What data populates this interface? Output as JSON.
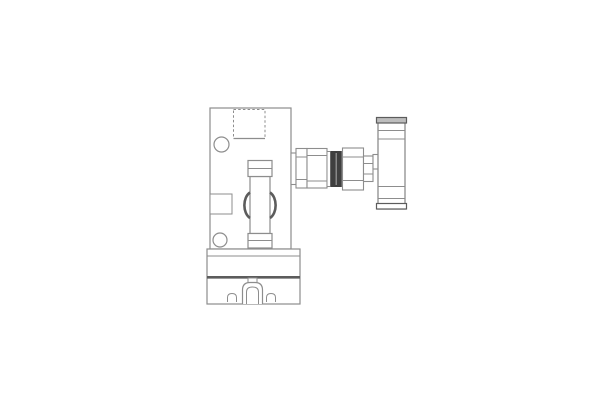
{
  "diagram": {
    "type": "technical-drawing",
    "description": "Orthographic line drawing of a valve fitting assembly with T-handle mounted on a plate and base block",
    "canvas": {
      "width": 600,
      "height": 400,
      "background": "#ffffff"
    },
    "palette": {
      "line": "#8d8d8d",
      "line_dark": "#5c5c5c",
      "seal_dark": "#3f3f3f",
      "cap_fill": "#bdbdbd",
      "white": "#ffffff"
    },
    "parts": [
      {
        "name": "mounting-plate",
        "shape": "rect",
        "x": 210,
        "y": 108,
        "w": 81,
        "h": 141,
        "stroke": "line",
        "fill": "white",
        "sw": 1.2
      },
      {
        "name": "base-block",
        "shape": "rect",
        "x": 207,
        "y": 249,
        "w": 93,
        "h": 55,
        "stroke": "line",
        "fill": "white",
        "sw": 1.2
      },
      {
        "name": "base-upper-line",
        "shape": "line",
        "x1": 207,
        "y1": 256,
        "x2": 300,
        "y2": 256,
        "stroke": "line",
        "sw": 1
      },
      {
        "name": "base-heavy-line",
        "shape": "line",
        "x1": 207,
        "y1": 277.3,
        "x2": 300,
        "y2": 277.3,
        "stroke": "line_dark",
        "sw": 2.6
      },
      {
        "name": "square-cutout",
        "shape": "rect",
        "x": 233.5,
        "y": 109.5,
        "w": 31.5,
        "h": 29,
        "stroke": "line",
        "fill": "none",
        "sw": 1,
        "dash": "2.5,2.2"
      },
      {
        "name": "square-cutout-bottom-edge",
        "shape": "line",
        "x1": 233.5,
        "y1": 138.5,
        "x2": 265,
        "y2": 138.5,
        "stroke": "line",
        "sw": 1.2
      },
      {
        "name": "upper-bolt-hole",
        "shape": "circle",
        "cx": 221.5,
        "cy": 144.5,
        "r": 7.5,
        "stroke": "line",
        "fill": "white",
        "sw": 1.2
      },
      {
        "name": "side-port-block",
        "shape": "rect",
        "x": 210,
        "y": 194,
        "w": 22,
        "h": 20,
        "stroke": "line",
        "fill": "white",
        "sw": 1
      },
      {
        "name": "lower-bolt-hole",
        "shape": "circle",
        "cx": 220,
        "cy": 240,
        "r": 7,
        "stroke": "line",
        "fill": "white",
        "sw": 1.2
      },
      {
        "name": "spindle-body",
        "shape": "rect",
        "x": 250,
        "y": 176.5,
        "w": 20,
        "h": 57,
        "stroke": "line",
        "fill": "white",
        "sw": 1.2
      },
      {
        "name": "spindle-top-collar",
        "shape": "rect",
        "x": 248,
        "y": 160.5,
        "w": 24,
        "h": 16,
        "stroke": "line",
        "fill": "white",
        "sw": 1.2
      },
      {
        "name": "spindle-top-collar-line",
        "shape": "line",
        "x1": 248,
        "y1": 168.5,
        "x2": 272,
        "y2": 168.5,
        "stroke": "line",
        "sw": 1
      },
      {
        "name": "spindle-bottom-collar",
        "shape": "rect",
        "x": 248,
        "y": 233.5,
        "w": 24,
        "h": 14.5,
        "stroke": "line",
        "fill": "white",
        "sw": 1.2
      },
      {
        "name": "spindle-bottom-collar-line",
        "shape": "line",
        "x1": 248,
        "y1": 240.5,
        "x2": 272,
        "y2": 240.5,
        "stroke": "line",
        "sw": 1
      },
      {
        "name": "left-grip-arc",
        "shape": "path",
        "d": "M 250 192.5 C 242.5 197.5 242.5 213 250 218",
        "stroke": "line_dark",
        "fill": "none",
        "sw": 2.6
      },
      {
        "name": "right-grip-arc",
        "shape": "path",
        "d": "M 270 192.5 C 277.5 197.5 277.5 213 270 218",
        "stroke": "line_dark",
        "fill": "none",
        "sw": 2.6
      },
      {
        "name": "clamp-foot-tab",
        "shape": "rect",
        "x": 248,
        "y": 278,
        "w": 9,
        "h": 4.5,
        "stroke": "line",
        "fill": "white",
        "sw": 1
      },
      {
        "name": "clamp-foot-outer",
        "shape": "path",
        "d": "M 242.5 304 L 242.5 290 Q 242.5 282.5 250 282.5 L 255 282.5 Q 262.5 282.5 262.5 290 L 262.5 304",
        "stroke": "line",
        "fill": "white",
        "sw": 1.2
      },
      {
        "name": "clamp-foot-inner",
        "shape": "path",
        "d": "M 246.5 304 L 246.5 292 Q 246.5 287 252.5 287 Q 258.5 287 258.5 292 L 258.5 304",
        "stroke": "line",
        "fill": "none",
        "sw": 1
      },
      {
        "name": "left-foot-hole",
        "shape": "path",
        "d": "M 227.5 302 L 227.5 297.5 Q 227.5 293.5 232 293.5 Q 236.5 293.5 236.5 297.5 L 236.5 302",
        "stroke": "line",
        "fill": "none",
        "sw": 1
      },
      {
        "name": "right-foot-hole",
        "shape": "path",
        "d": "M 266.5 302 L 266.5 297.5 Q 266.5 293.5 271 293.5 Q 275.5 293.5 275.5 297.5 L 275.5 302",
        "stroke": "line",
        "fill": "none",
        "sw": 1
      },
      {
        "name": "union-washer",
        "shape": "rect",
        "x": 291,
        "y": 153,
        "w": 5,
        "h": 31.5,
        "stroke": "line",
        "fill": "white",
        "sw": 1.1
      },
      {
        "name": "union-nut",
        "shape": "rect",
        "x": 296,
        "y": 148.5,
        "w": 11,
        "h": 39.5,
        "stroke": "line",
        "fill": "white",
        "sw": 1.1
      },
      {
        "name": "union-nut-chamfer-top",
        "shape": "line",
        "x1": 296,
        "y1": 157,
        "x2": 307,
        "y2": 157,
        "stroke": "line",
        "sw": 1
      },
      {
        "name": "union-nut-chamfer-bottom",
        "shape": "line",
        "x1": 296,
        "y1": 179.5,
        "x2": 307,
        "y2": 179.5,
        "stroke": "line",
        "sw": 1
      },
      {
        "name": "union-body",
        "shape": "rect",
        "x": 307,
        "y": 148.5,
        "w": 20,
        "h": 39.5,
        "stroke": "line",
        "fill": "white",
        "sw": 1.1
      },
      {
        "name": "union-body-chamfer-top",
        "shape": "line",
        "x1": 307,
        "y1": 155.5,
        "x2": 327,
        "y2": 155.5,
        "stroke": "line",
        "sw": 1
      },
      {
        "name": "union-body-chamfer-bottom",
        "shape": "line",
        "x1": 307,
        "y1": 181,
        "x2": 327,
        "y2": 181,
        "stroke": "line",
        "sw": 1
      },
      {
        "name": "union-spacer",
        "shape": "rect",
        "x": 327,
        "y": 151.5,
        "w": 3.5,
        "h": 35,
        "stroke": "line",
        "fill": "white",
        "sw": 1
      },
      {
        "name": "seal-ring",
        "shape": "rect",
        "x": 330.5,
        "y": 151,
        "w": 11.3,
        "h": 36,
        "stroke": "none",
        "fill": "seal_dark",
        "sw": 0
      },
      {
        "name": "seal-ring-slit",
        "shape": "line",
        "x1": 336.2,
        "y1": 153,
        "x2": 336.2,
        "y2": 185,
        "stroke": "#9a9a9a",
        "sw": 1.2
      },
      {
        "name": "gland-nut",
        "shape": "rect",
        "x": 342.5,
        "y": 148,
        "w": 21,
        "h": 42,
        "stroke": "line",
        "fill": "white",
        "sw": 1.1
      },
      {
        "name": "gland-nut-chamfer-top",
        "shape": "line",
        "x1": 342.5,
        "y1": 157,
        "x2": 363.5,
        "y2": 157,
        "stroke": "line",
        "sw": 1
      },
      {
        "name": "gland-nut-chamfer-bottom",
        "shape": "line",
        "x1": 342.5,
        "y1": 180.5,
        "x2": 363.5,
        "y2": 180.5,
        "stroke": "line",
        "sw": 1
      },
      {
        "name": "valve-stem",
        "shape": "rect",
        "x": 363.5,
        "y": 156,
        "w": 9.5,
        "h": 25.5,
        "stroke": "line",
        "fill": "white",
        "sw": 1.1
      },
      {
        "name": "valve-stem-line-top",
        "shape": "line",
        "x1": 363.5,
        "y1": 163.5,
        "x2": 373,
        "y2": 163.5,
        "stroke": "line",
        "sw": 1
      },
      {
        "name": "valve-stem-line-bottom",
        "shape": "line",
        "x1": 363.5,
        "y1": 174,
        "x2": 373,
        "y2": 174,
        "stroke": "line",
        "sw": 1
      },
      {
        "name": "stem-tab",
        "shape": "rect",
        "x": 373,
        "y": 154.5,
        "w": 7,
        "h": 14.5,
        "stroke": "line",
        "fill": "white",
        "sw": 1.1
      },
      {
        "name": "handle-body",
        "shape": "rect",
        "x": 378,
        "y": 118,
        "w": 27,
        "h": 91,
        "stroke": "line",
        "fill": "white",
        "sw": 1.3
      },
      {
        "name": "handle-top-cap",
        "shape": "rect",
        "x": 376.5,
        "y": 117.5,
        "w": 30,
        "h": 5.5,
        "stroke": "line_dark",
        "fill": "cap_fill",
        "sw": 1.2
      },
      {
        "name": "handle-line-1",
        "shape": "line",
        "x1": 378,
        "y1": 130.5,
        "x2": 405,
        "y2": 130.5,
        "stroke": "line",
        "sw": 1
      },
      {
        "name": "handle-line-2",
        "shape": "line",
        "x1": 378,
        "y1": 139,
        "x2": 405,
        "y2": 139,
        "stroke": "line",
        "sw": 1
      },
      {
        "name": "handle-line-3",
        "shape": "line",
        "x1": 378,
        "y1": 186.5,
        "x2": 405,
        "y2": 186.5,
        "stroke": "line",
        "sw": 1
      },
      {
        "name": "handle-line-4",
        "shape": "line",
        "x1": 378,
        "y1": 198.5,
        "x2": 405,
        "y2": 198.5,
        "stroke": "line",
        "sw": 1
      },
      {
        "name": "handle-bottom-cap",
        "shape": "rect",
        "x": 376.5,
        "y": 203.5,
        "w": 30,
        "h": 5.5,
        "stroke": "line_dark",
        "fill": "white",
        "sw": 1.2
      }
    ]
  }
}
